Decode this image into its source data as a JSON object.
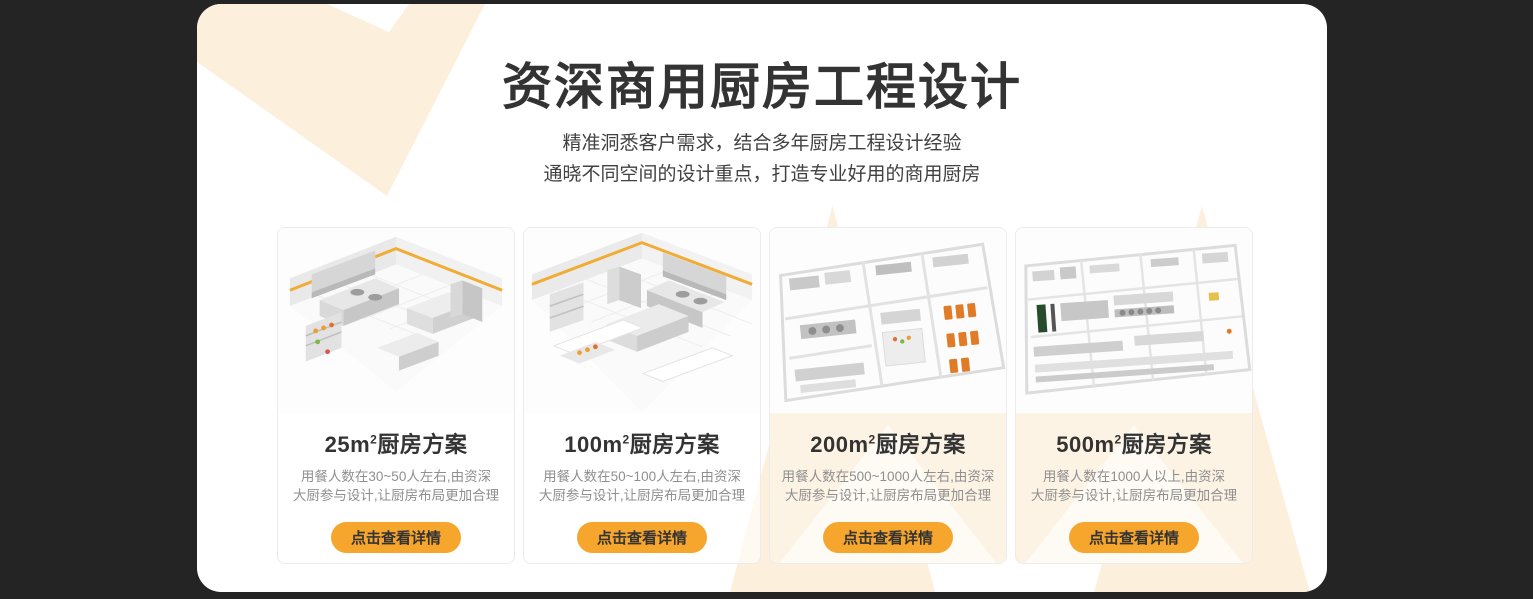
{
  "theme": {
    "background": "#242424",
    "panel": "#ffffff",
    "accent_orange": "#f6a52d",
    "watermark_cream": "#fcefdc",
    "title_color": "#333333",
    "description_color": "#8f8f8f"
  },
  "header": {
    "title": "资深商用厨房工程设计",
    "subtitle_lines": [
      "精准洞悉客户需求，结合多年厨房工程设计经验",
      "通晓不同空间的设计重点，打造专业好用的商用厨房"
    ]
  },
  "cards": [
    {
      "title_area": "25m",
      "title_sup": "2",
      "title_suffix": "厨房方案",
      "description": "用餐人数在30~50人左右,由资深\n大厨参与设计,让厨房布局更加合理",
      "button_label": "点击查看详情"
    },
    {
      "title_area": "100m",
      "title_sup": "2",
      "title_suffix": "厨房方案",
      "description": "用餐人数在50~100人左右,由资深\n大厨参与设计,让厨房布局更加合理",
      "button_label": "点击查看详情"
    },
    {
      "title_area": "200m",
      "title_sup": "2",
      "title_suffix": "厨房方案",
      "description": "用餐人数在500~1000人左右,由资深\n大厨参与设计,让厨房布局更加合理",
      "button_label": "点击查看详情"
    },
    {
      "title_area": "500m",
      "title_sup": "2",
      "title_suffix": "厨房方案",
      "description": "用餐人数在1000人以上,由资深\n大厨参与设计,让厨房布局更加合理",
      "button_label": "点击查看详情"
    }
  ]
}
